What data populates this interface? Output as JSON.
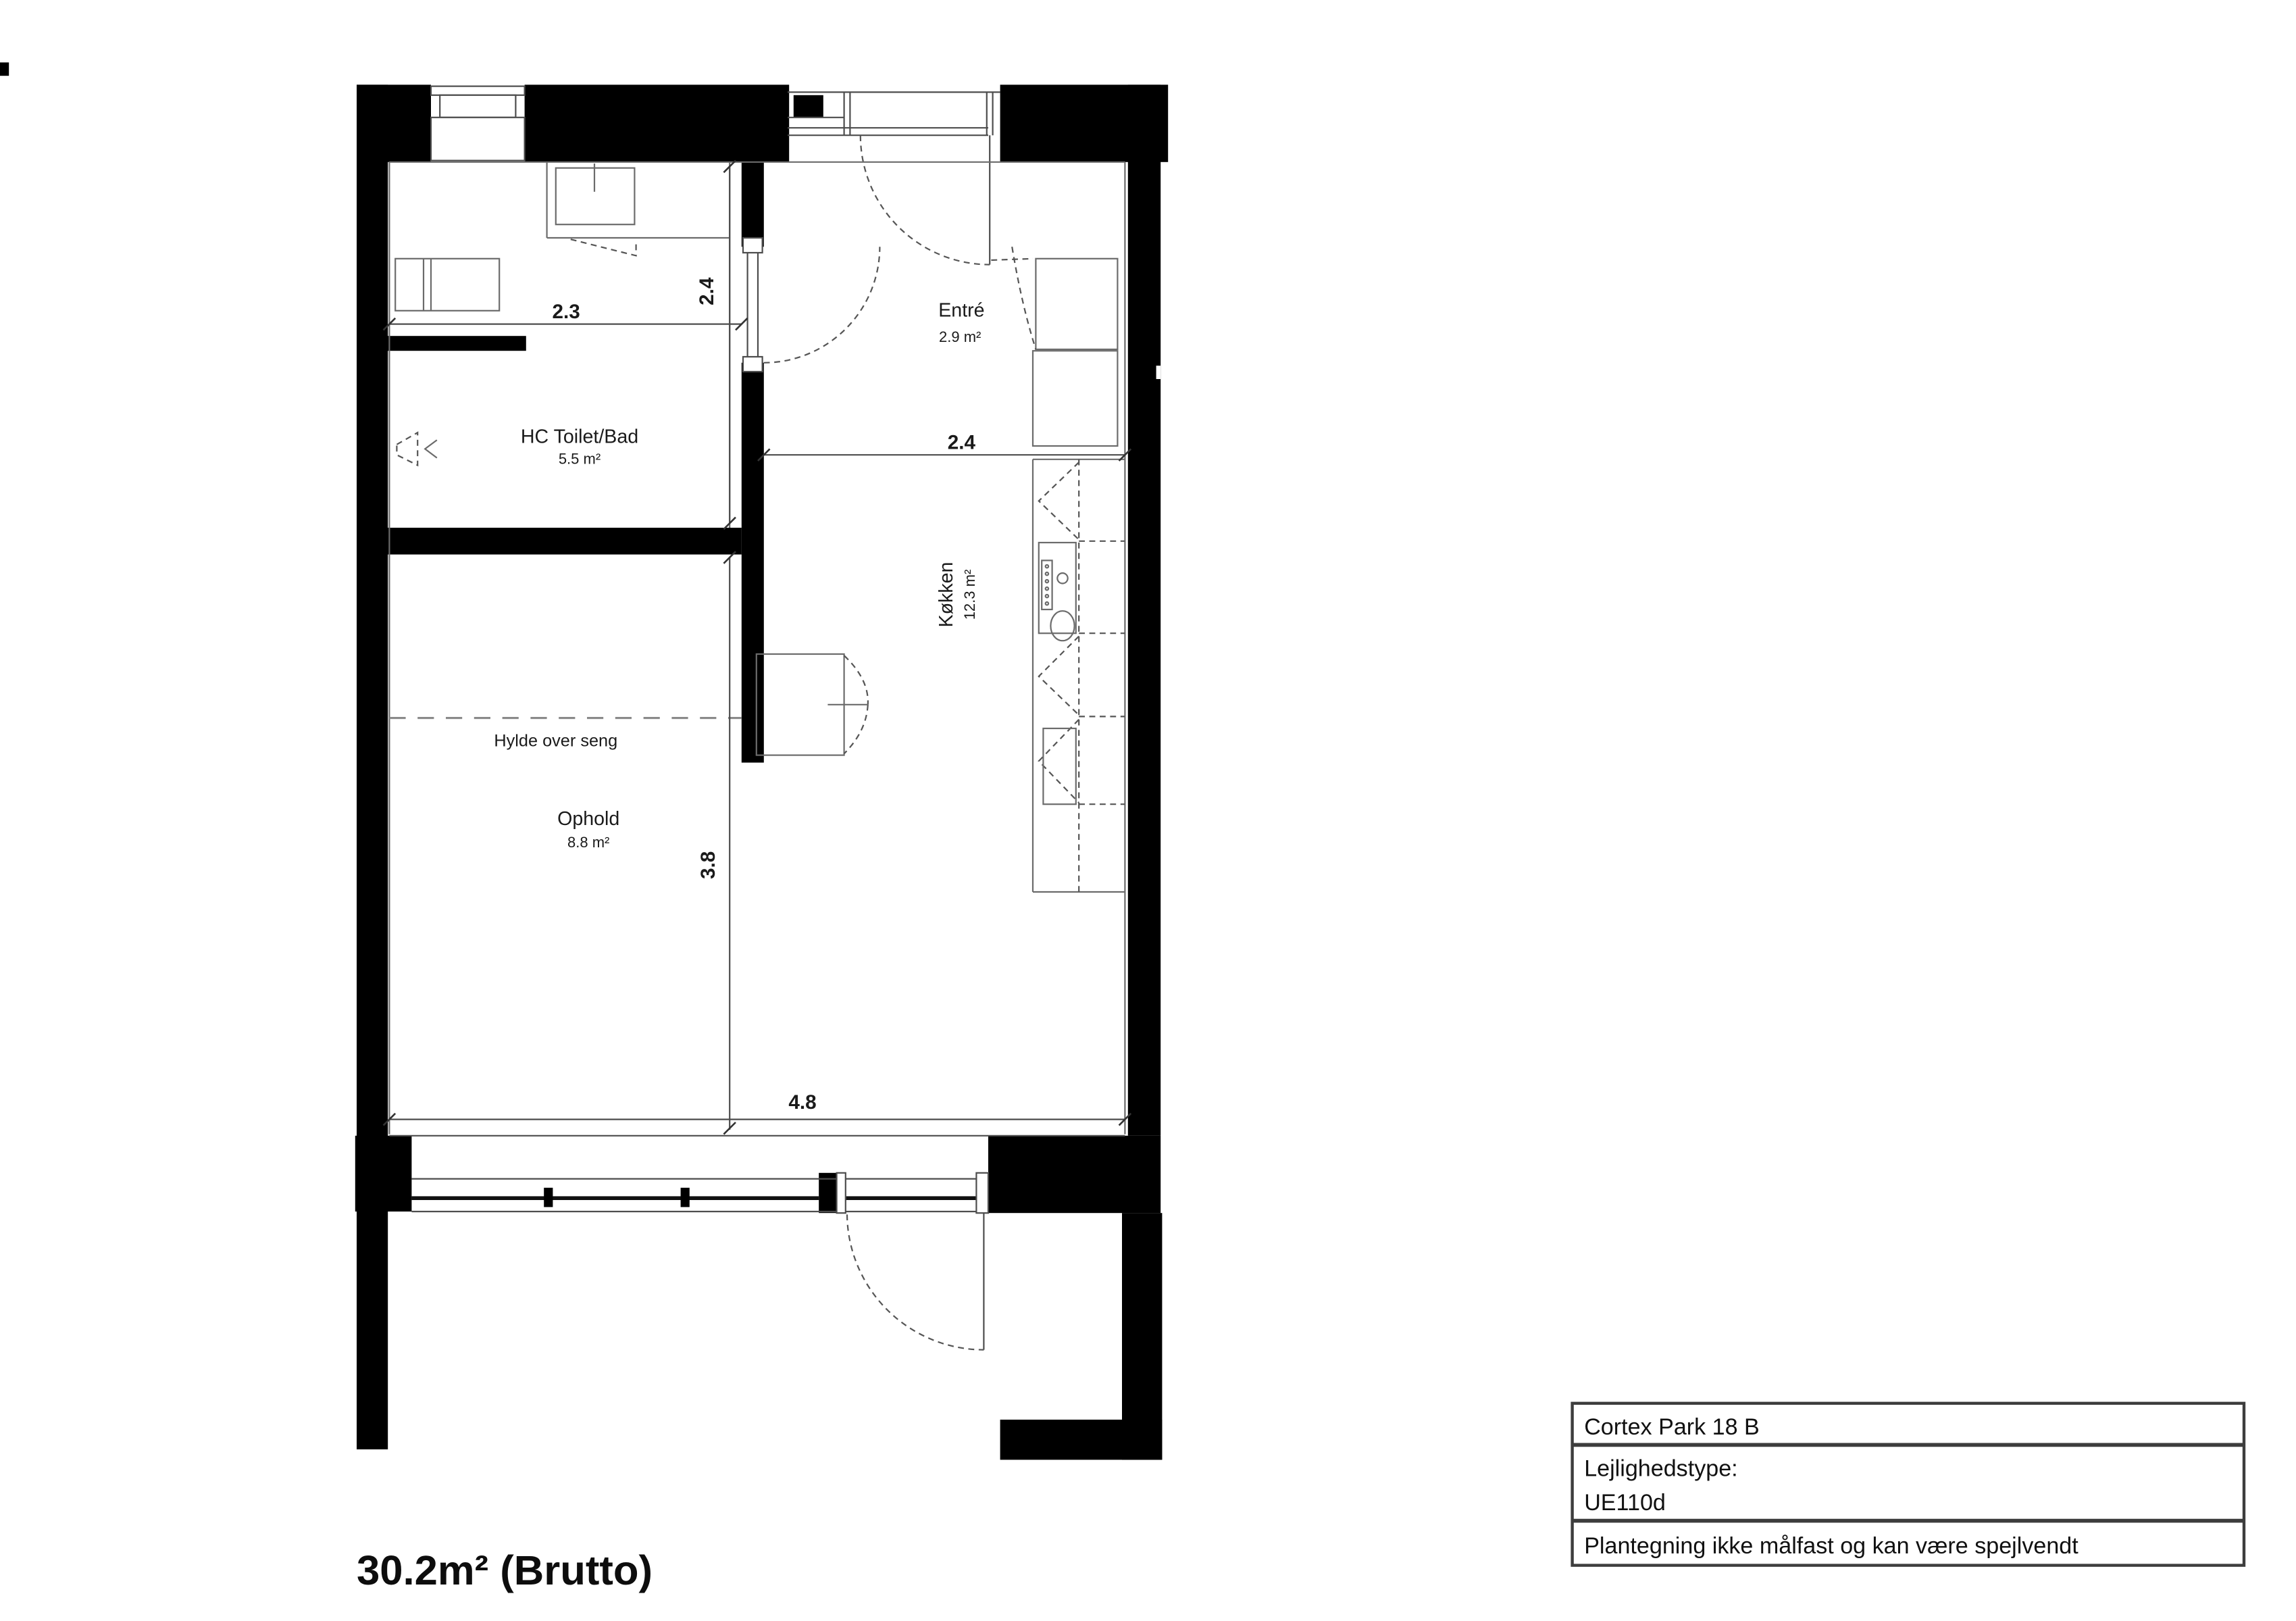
{
  "plan": {
    "rooms": [
      {
        "name": "Entré",
        "area": "2.9 m²"
      },
      {
        "name": "HC Toilet/Bad",
        "area": "5.5 m²"
      },
      {
        "name": "Køkken",
        "area": "12.3 m²"
      },
      {
        "name": "Ophold",
        "area": "8.8 m²"
      }
    ],
    "annotation": "Hylde over seng",
    "dimensions": {
      "toilet_width": "2.3",
      "toilet_depth": "2.4",
      "kitchen_width": "2.4",
      "living_depth": "3.8",
      "living_width": "4.8"
    },
    "gross_area": "30.2m² (Brutto)"
  },
  "title_block": {
    "address": "Cortex Park 18 B",
    "type_label": "Lejlighedstype:",
    "type_value": "UE110d",
    "disclaimer": "Plantegning ikke målfast og kan være spejlvendt"
  },
  "colors": {
    "wall": "#000000",
    "line": "#4d4d4d",
    "text": "#1a1a1a"
  }
}
